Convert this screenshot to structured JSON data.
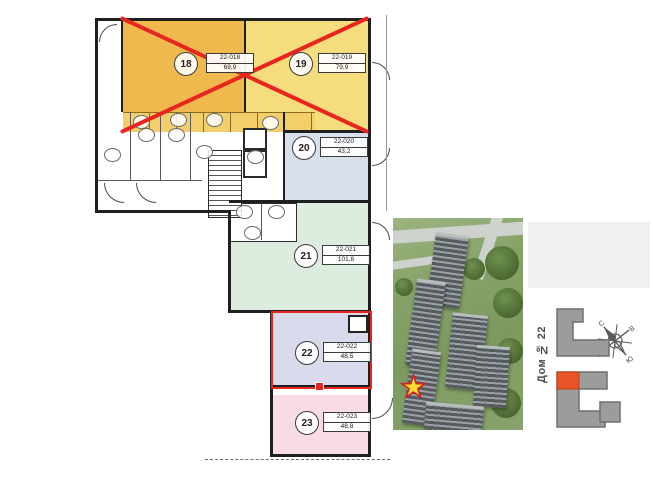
{
  "floor_plan": {
    "units": [
      {
        "number": "18",
        "code": "22-018",
        "area": "69,9",
        "status": "unavailable"
      },
      {
        "number": "19",
        "code": "22-019",
        "area": "79,9",
        "status": "unavailable"
      },
      {
        "number": "20",
        "code": "22-020",
        "area": "43,2",
        "status": "available"
      },
      {
        "number": "21",
        "code": "22-021",
        "area": "101,8",
        "status": "available"
      },
      {
        "number": "22",
        "code": "22-022",
        "area": "48,5",
        "status": "selected"
      },
      {
        "number": "23",
        "code": "22-023",
        "area": "48,8",
        "status": "available"
      }
    ],
    "colors": {
      "unit18": "#efb94d",
      "unit19": "#f5dd7e",
      "unit20": "#dadfee",
      "unit21": "#dcecdf",
      "unit22": "#dadaed",
      "unit23": "#f8dbe3",
      "cross": "#e8251f",
      "selection": "#e8251f",
      "wall": "#1f1f1f"
    }
  },
  "aerial_view": {
    "marker_icon": "star-icon",
    "marker_glyph": "★",
    "marker_color": "#ffdf35",
    "marker_outline": "#d81f1f"
  },
  "site_panel": {
    "house_label": "Дом № 22",
    "compass": {
      "north": "С",
      "south": "Ю",
      "east": "В",
      "west": "З"
    },
    "colors": {
      "building": "#9c9c9c",
      "highlight": "#e85426",
      "panel_bg": "#f0f0f1"
    }
  }
}
